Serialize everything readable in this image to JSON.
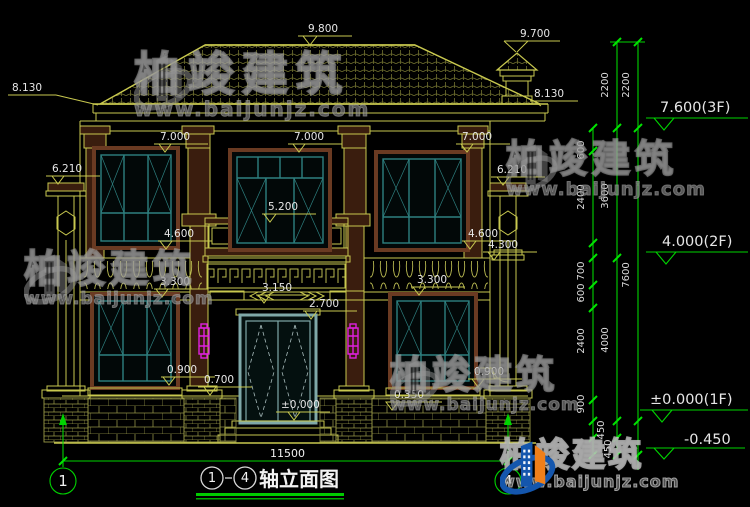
{
  "drawing": {
    "title": {
      "axis_start": "1",
      "axis_end": "4",
      "text": "轴立面图"
    },
    "axes": {
      "left": "1",
      "right": "4"
    },
    "bottom_width": "11500",
    "dims": {
      "d9800": "9.800",
      "d9700": "9.700",
      "d8130": "8.130",
      "d7000": "7.000",
      "d6210": "6.210",
      "d5200": "5.200",
      "d4600": "4.600",
      "d4300": "4.300",
      "d3300": "3.300",
      "d3150": "3.150",
      "d2700": "2.700",
      "d0900": "0.900",
      "d0700": "0.700",
      "d0350": "0.350",
      "d0000": "±0.000"
    },
    "chain": {
      "c2200": "2200",
      "c3600": "3600",
      "c4000": "4000",
      "c7600": "7600",
      "c600": "600",
      "c700": "700",
      "c2400": "2400",
      "c900": "900",
      "c450": "450"
    },
    "levels": {
      "f3": "7.600(3F)",
      "f2": "4.000(2F)",
      "f1": "±0.000(1F)",
      "below": "-0.450"
    }
  },
  "watermark": {
    "brand": "柏竣建筑",
    "url": "www.baijunjz.com"
  },
  "colors": {
    "background": "#000000",
    "facade_lines": "#c8c84f",
    "green_dims": "#00d400",
    "dim_text": "#e6e6e6",
    "window_teal": "#2e8080",
    "frame_brown": "#6a3a22",
    "lamp_magenta": "#e020e0",
    "logo_blue": "#1456ad",
    "logo_orange": "#ef7f1a"
  }
}
